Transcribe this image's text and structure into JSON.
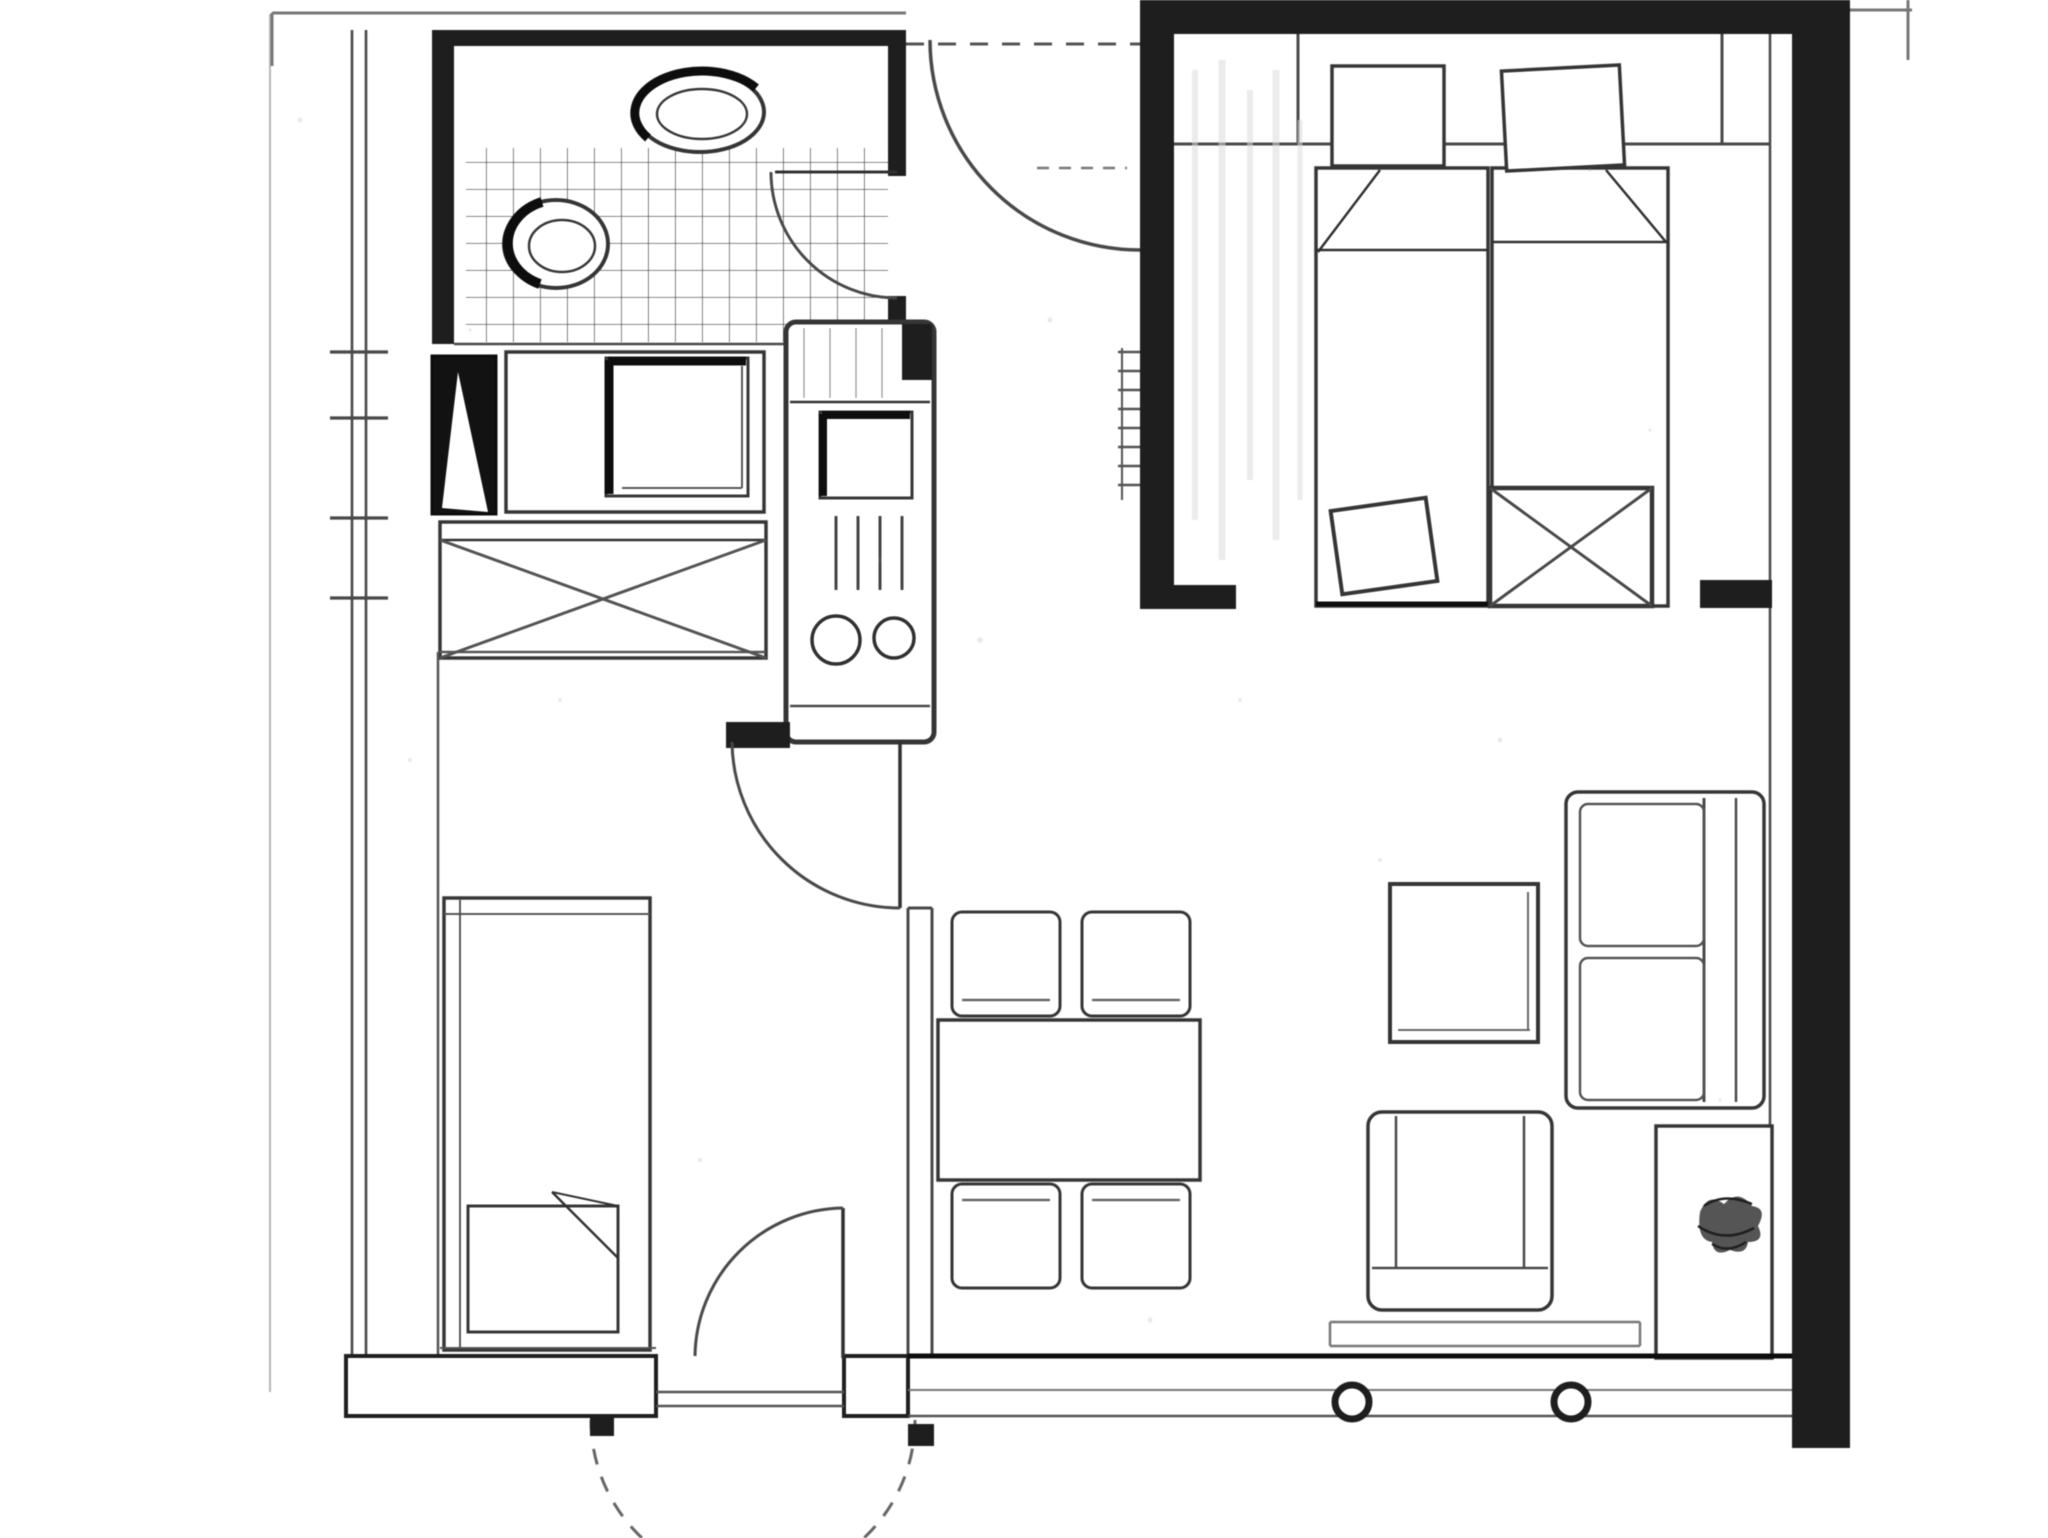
{
  "document": {
    "kind": "scanned apartment floor plan drawing",
    "visible_text": "",
    "width_px": 2048,
    "height_px": 1538
  },
  "palette": {
    "paper": "#ffffff",
    "ink": "#222222",
    "ink_mid": "#4a4a4a",
    "ink_light": "#777777",
    "pencil_faint": "#b5b5b5"
  },
  "rooms": {
    "bathroom": {
      "label": "Bathroom with tiled shower floor, washbasin and WC"
    },
    "kitchen": {
      "label": "Kitchenette with vent shaft, sink counter, cooker unit with two burners and crossed cabinet"
    },
    "hall": {
      "label": "Entrance hall with radiator marks"
    },
    "bedroom": {
      "label": "Bedroom with two single beds, pillows, folded blankets, blanket chest and wardrobe shelf"
    },
    "alcove": {
      "label": "Sleeping alcove with single bed and folded blanket"
    },
    "living": {
      "label": "Living and dining area with dining table, four chairs, sofa, side table, armchair and sideboard with plant"
    }
  },
  "doors": {
    "entry_top": {
      "label": "Apartment entrance door with quarter-circle swing and dashed lintel"
    },
    "bathroom_door": {
      "label": "Bathroom door swinging onto tiles"
    },
    "alcove_door": {
      "label": "Door between hall and sleeping alcove"
    },
    "bedroom_opening": {
      "label": "Bedroom opening near right wall"
    },
    "terrace_door": {
      "label": "Bottom entrance door with inward leaf and dashed outside swing"
    }
  },
  "windows": {
    "left_wall_marks": {
      "label": "Masonry break tick marks on left exterior wall"
    },
    "south_front": {
      "label": "South window front with two round fittings"
    }
  },
  "furniture": {
    "washbasin": "oval washbasin",
    "wc": "oval WC pan",
    "shower_tiles": "square tile grid",
    "vent_shaft": "black shaft with white wedge",
    "sink_counter": "counter with shadowed sink bowl",
    "cooker_unit": "tall unit: small sink, rack bars, two burner rings",
    "x_cabinet": "low cabinet crossed with X",
    "bed_double_left": "single bed, fold at top left",
    "bed_double_right": "single bed, fold at top right",
    "blanket_chest": "X-crossed chest at bed foot",
    "cushion": "tilted cushion at bed foot",
    "alcove_bed": "single bed with pillow and diagonal fold",
    "dining_table": "rectangular table",
    "dining_chairs": "four square chairs",
    "sofa": "two-seat sofa against right wall",
    "side_table": "square side table",
    "armchair": "armchair facing sofa",
    "sideboard": "sideboard with scribbled plant",
    "bench_track": "low double line in front of window"
  }
}
